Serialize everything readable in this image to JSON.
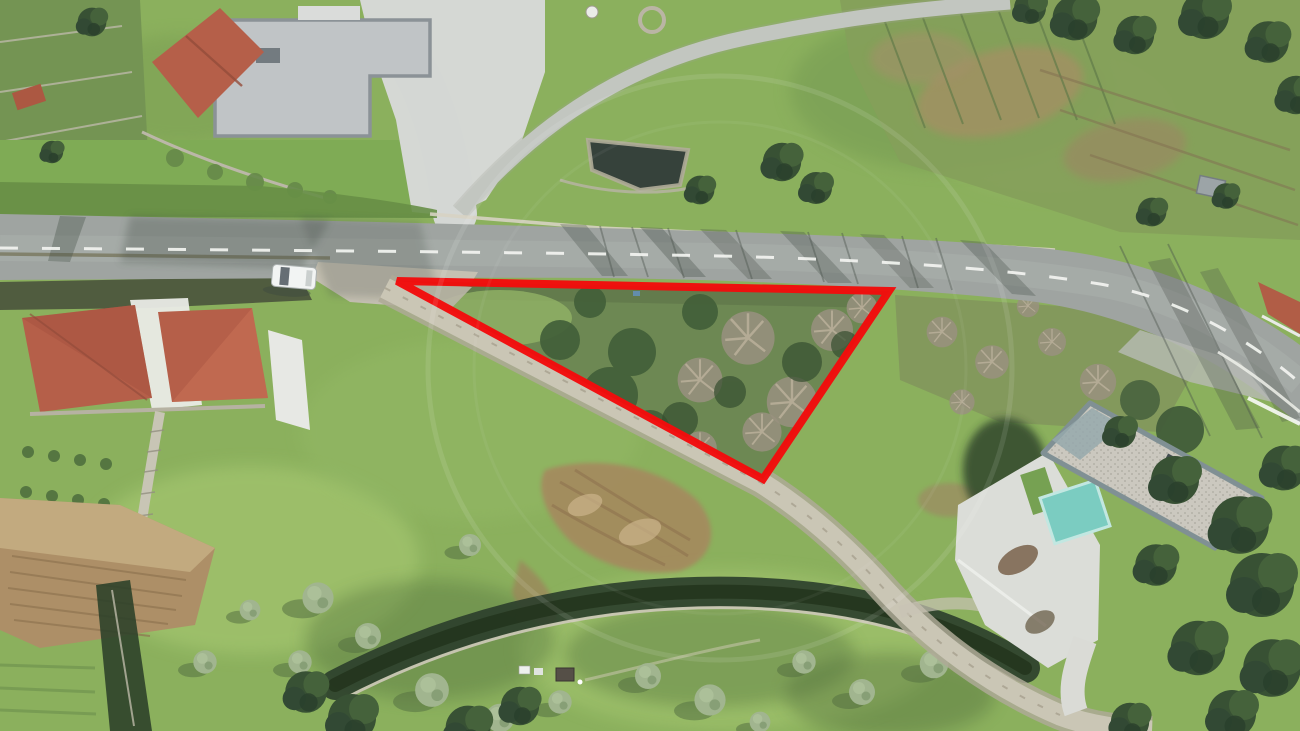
{
  "page": {
    "kind": "aerial-drone-photo",
    "subject": "Hillside building plot outlined in red between an asphalt road and a dirt track, with neighbouring rural houses"
  },
  "overlay": {
    "plot_boundary": {
      "shape": "triangle",
      "points": "397,281 889,291 763,479",
      "stroke_color": "#f20000",
      "stroke_width": "8"
    },
    "watermark": {
      "shape": "circle",
      "opacity": "0.10"
    }
  },
  "scene": {
    "colors": {
      "grass": "#85ac55",
      "grass_sunlit": "#a6c96c",
      "road_asphalt": "#9aa09c",
      "dirt_track": "#c8c3b2",
      "concrete": "#d3d6d2",
      "flat_roof": "#bdc1c3",
      "tile_roof": "#b25740",
      "pool_water": "#74cabe",
      "pond_water": "#2c3831",
      "tilled_soil": "#a98a5f",
      "dark_trees": "#2e482a",
      "olive_canopy": "#9cb189",
      "bare_scrub": "#948c79",
      "car_body": "#f2f4f3"
    },
    "elements": [
      "asphalt road with dashed centerline",
      "red triangular plot boundary overlay",
      "dirt track along plot hypotenuse",
      "modern flat-roof house top left",
      "tile-roofed houses left",
      "modern house with swimming pool bottom right",
      "walled pond top centre",
      "tilled garden plot bottom left",
      "olive trees and meadows",
      "parked white car on road"
    ]
  }
}
